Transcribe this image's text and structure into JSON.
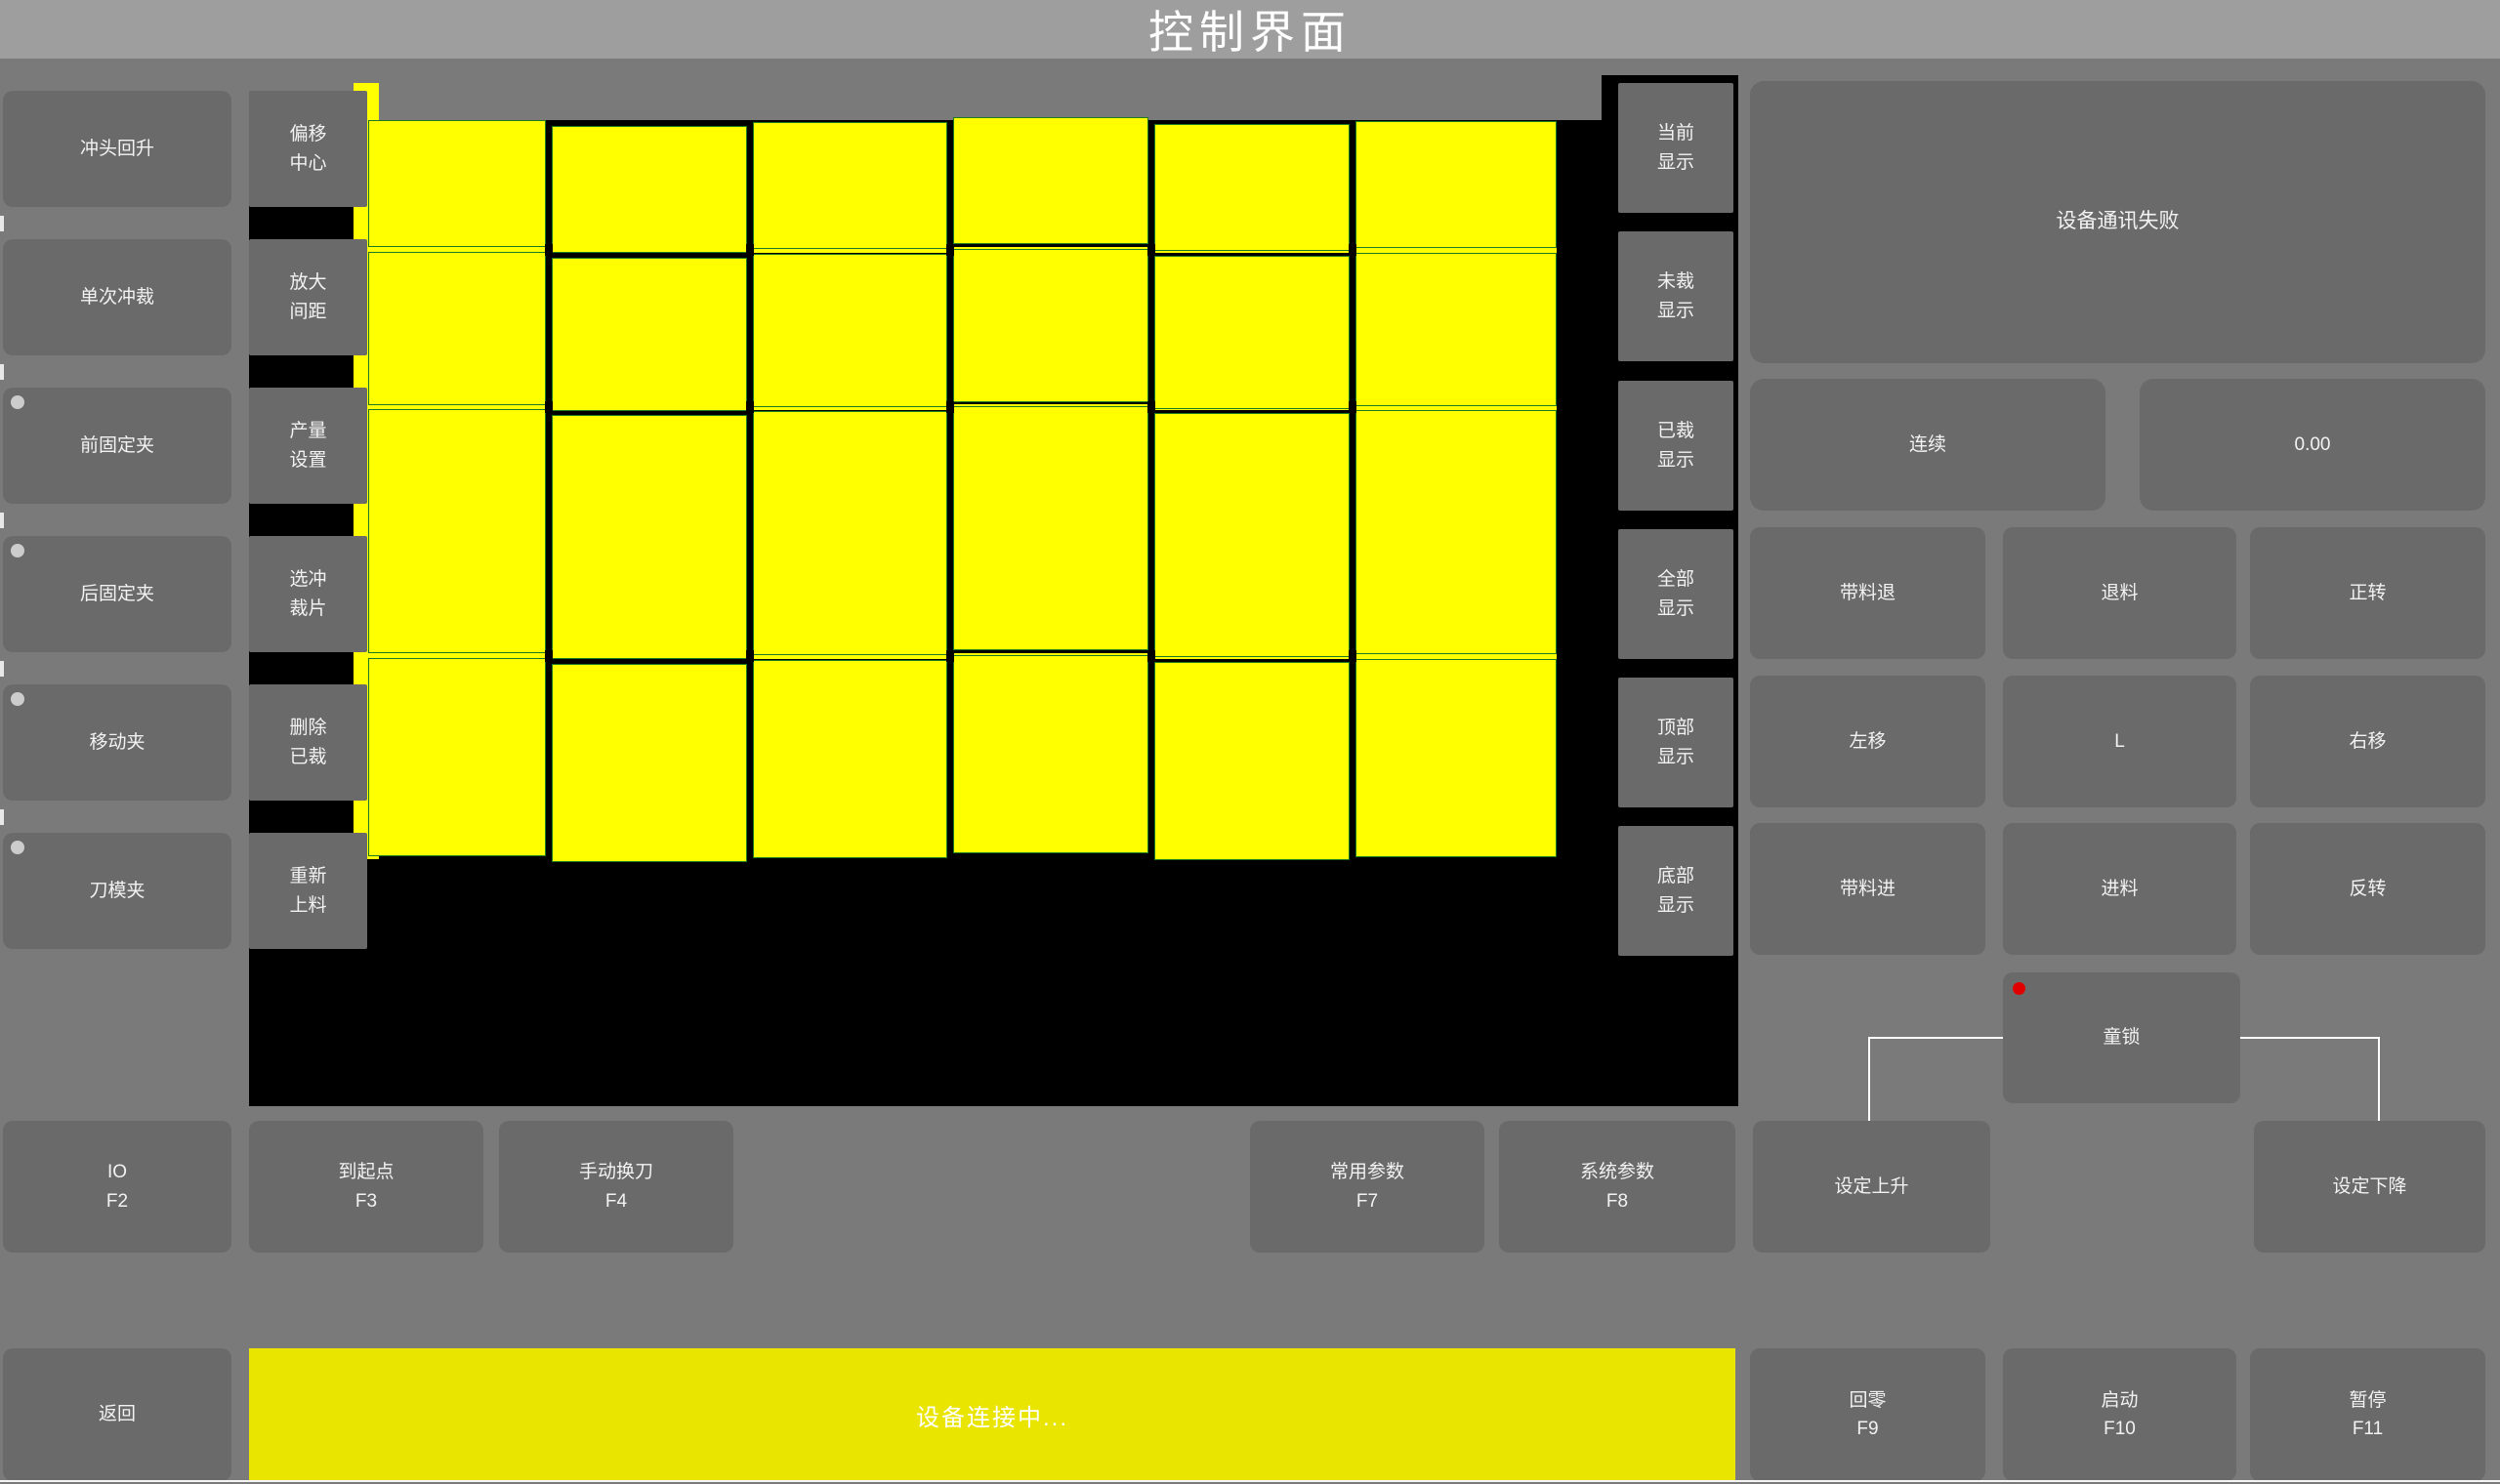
{
  "title": "控制界面",
  "colors": {
    "bg": "#7a7a7a",
    "titlebar": "#9e9e9e",
    "btn": "#6a6a6a",
    "btn-text": "#f2f2f2",
    "canvas": "#000000",
    "piece": "#ffff00",
    "piece-border": "#1e7a1e",
    "bar-yellow": "#e9e400",
    "dot": "#cccccc",
    "led": "#e00000",
    "line": "#ffffff"
  },
  "left_panel": {
    "buttons": [
      {
        "label": "冲头回升",
        "indicator": false
      },
      {
        "label": "单次冲裁",
        "indicator": false
      },
      {
        "label": "前固定夹",
        "indicator": true
      },
      {
        "label": "后固定夹",
        "indicator": true
      },
      {
        "label": "移动夹",
        "indicator": true
      },
      {
        "label": "刀模夹",
        "indicator": true
      }
    ]
  },
  "tool_column": {
    "buttons": [
      {
        "line1": "偏移",
        "line2": "中心"
      },
      {
        "line1": "放大",
        "line2": "间距"
      },
      {
        "line1": "产量",
        "line2": "设置"
      },
      {
        "line1": "选冲",
        "line2": "裁片"
      },
      {
        "line1": "删除",
        "line2": "已裁"
      },
      {
        "line1": "重新",
        "line2": "上料"
      }
    ]
  },
  "display_column": {
    "buttons": [
      {
        "line1": "当前",
        "line2": "显示"
      },
      {
        "line1": "未裁",
        "line2": "显示"
      },
      {
        "line1": "已裁",
        "line2": "显示"
      },
      {
        "line1": "全部",
        "line2": "显示"
      },
      {
        "line1": "顶部",
        "line2": "显示"
      },
      {
        "line1": "底部",
        "line2": "显示"
      }
    ]
  },
  "canvas": {
    "cols": [
      380,
      562,
      768,
      973,
      1179,
      1385,
      1597
    ],
    "rows": [
      [
        123,
        253
      ],
      [
        258,
        415
      ],
      [
        419,
        669
      ],
      [
        674,
        877
      ]
    ],
    "col_offsets": [
      0,
      6,
      2,
      -3,
      4,
      1
    ]
  },
  "right_panel": {
    "status_message": "设备通讯失败",
    "mode_button": "连续",
    "value_display": "0.00",
    "jog": [
      [
        "带料退",
        "退料",
        "正转"
      ],
      [
        "左移",
        "L",
        "右移"
      ],
      [
        "带料进",
        "进料",
        "反转"
      ]
    ],
    "child_lock": "童锁"
  },
  "bottom_row": [
    {
      "label": "IO",
      "fkey": "F2"
    },
    {
      "label": "到起点",
      "fkey": "F3"
    },
    {
      "label": "手动换刀",
      "fkey": "F4"
    },
    {
      "label": "常用参数",
      "fkey": "F7"
    },
    {
      "label": "系统参数",
      "fkey": "F8"
    },
    {
      "label": "设定上升",
      "fkey": ""
    },
    {
      "label": "设定下降",
      "fkey": ""
    }
  ],
  "status_bar": {
    "back": "返回",
    "message": "设备连接中...",
    "buttons": [
      {
        "label": "回零",
        "fkey": "F9"
      },
      {
        "label": "启动",
        "fkey": "F10"
      },
      {
        "label": "暂停",
        "fkey": "F11"
      }
    ]
  }
}
